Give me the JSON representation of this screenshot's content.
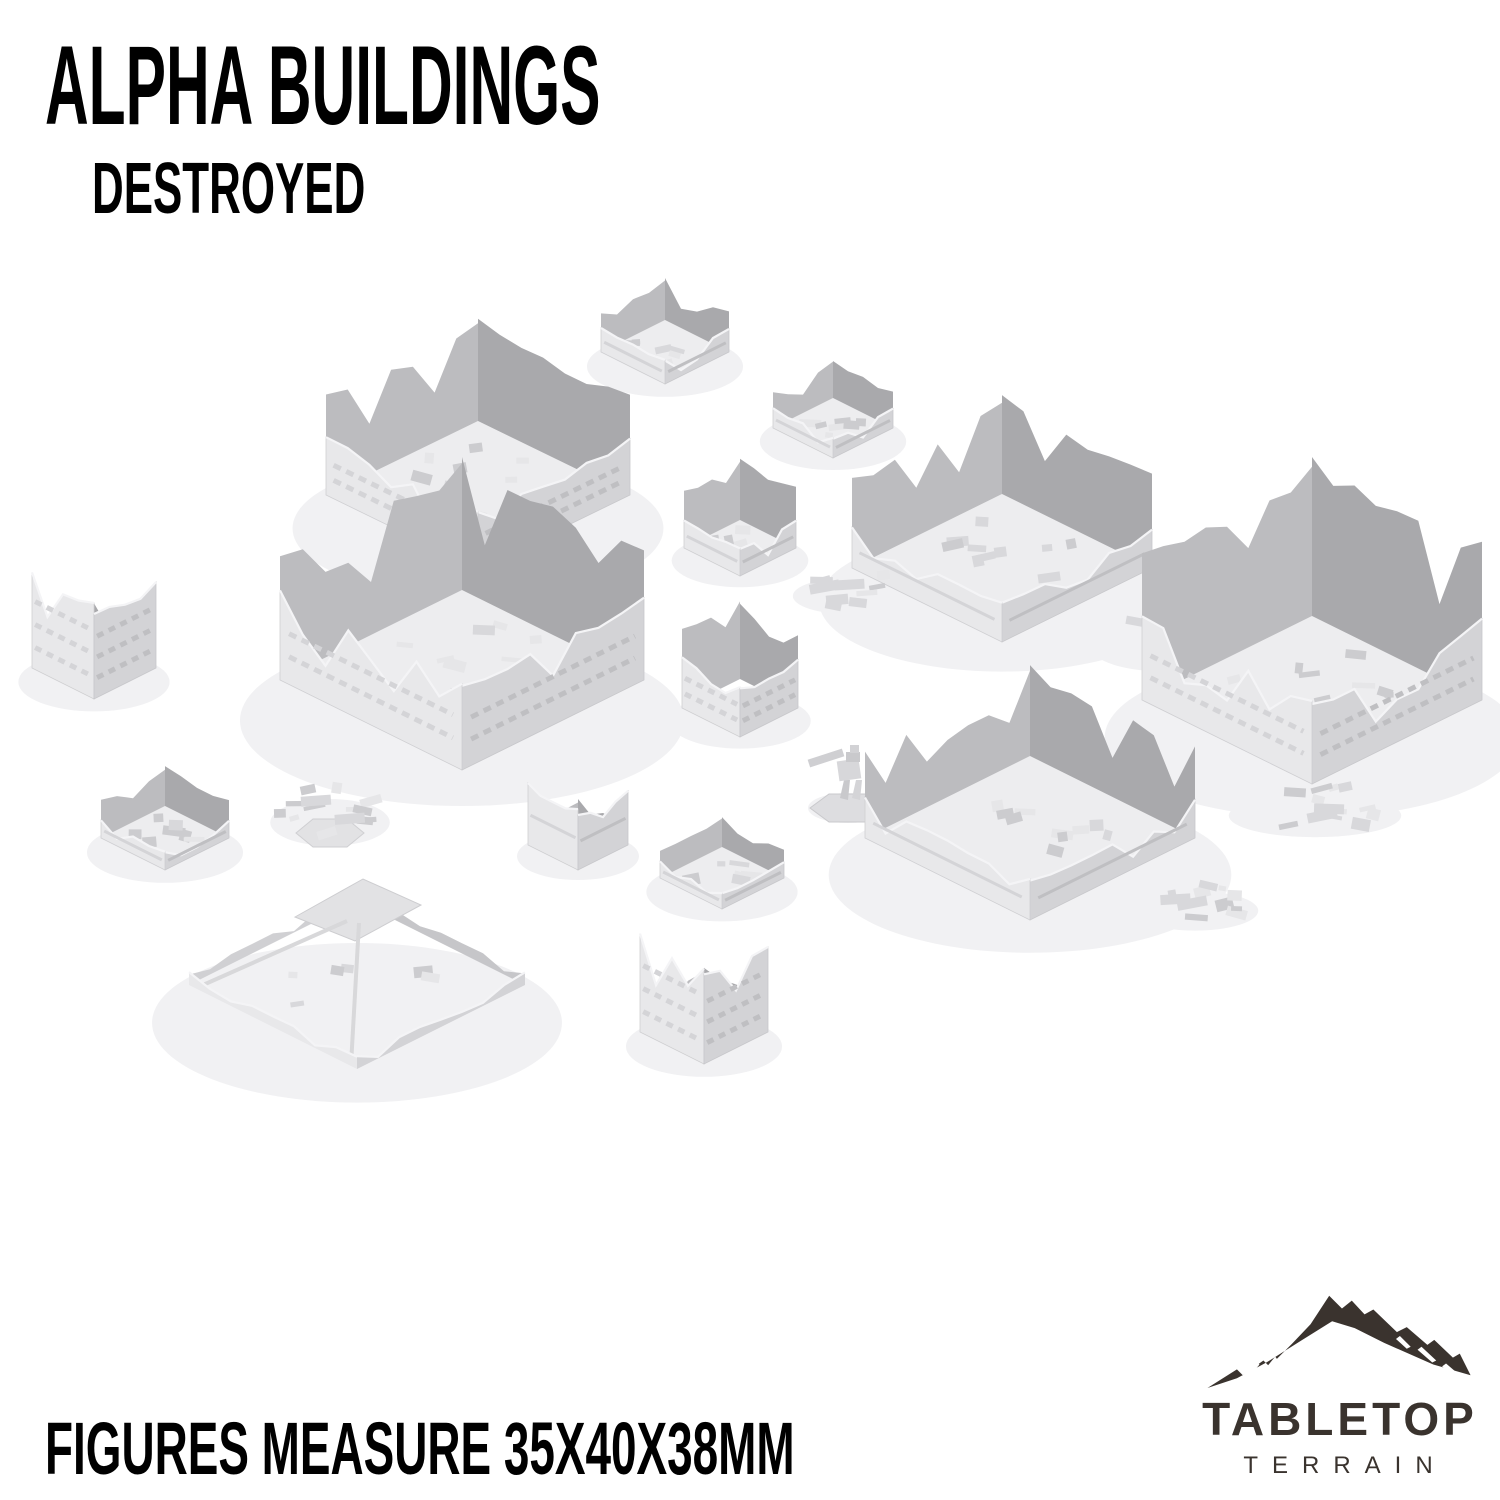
{
  "header": {
    "title": "ALPHA BUILDINGS",
    "subtitle": "DESTROYED"
  },
  "footer": {
    "note": "FIGURES MEASURE 35X40X38MM"
  },
  "logo": {
    "brand_top": "TABLETOP",
    "brand_bottom": "TERRAIN",
    "icon": "mountain-icon",
    "color": "#3a332e"
  },
  "palette": {
    "background": "#ffffff",
    "text": "#000000",
    "wall_lit": "#e8e8ea",
    "wall_shade": "#d3d3d6",
    "wall_top_highlight": "#f4f4f6",
    "interior_left": "#bcbcbf",
    "interior_right": "#a9a9ac",
    "floor": "#ededef",
    "band_lit": "#d4d4d7",
    "band_shade": "#bfbfc2",
    "rubble_light": "#e6e6e8",
    "rubble_mid": "#d8d8db",
    "rubble_dark": "#cccccf",
    "ground_shadow": "#f1f1f3",
    "logo_color": "#3a332e"
  },
  "scene": {
    "description": "Seventeen destroyed sci-fi building terrain models rendered in light grey on a white background",
    "models": [
      {
        "id": "ruin-small-top",
        "type": "enclosure",
        "cx": 665,
        "cy": 352,
        "hx": 64,
        "hy": 32,
        "hb": 42,
        "hf": 24,
        "seed": 11
      },
      {
        "id": "ruin-small-mid",
        "type": "enclosure",
        "cx": 833,
        "cy": 428,
        "hx": 60,
        "hy": 30,
        "hb": 38,
        "hf": 20,
        "seed": 22
      },
      {
        "id": "ruin-large-topleft",
        "type": "enclosure",
        "cx": 478,
        "cy": 495,
        "hx": 152,
        "hy": 74,
        "hb": 105,
        "hf": 58,
        "seed": 33,
        "windows": true
      },
      {
        "id": "ruin-wall-small-center",
        "type": "enclosure",
        "cx": 740,
        "cy": 548,
        "hx": 56,
        "hy": 28,
        "hb": 62,
        "hf": 28,
        "seed": 123
      },
      {
        "id": "ruin-large-center",
        "type": "enclosure",
        "cx": 1002,
        "cy": 568,
        "hx": 150,
        "hy": 74,
        "hb": 100,
        "hf": 40,
        "seed": 145
      },
      {
        "id": "rubble-center",
        "type": "rubble",
        "cx": 848,
        "cy": 588,
        "rx": 48,
        "ry": 20,
        "n": 10,
        "seed": 134
      },
      {
        "id": "rubble-center-right",
        "type": "rubble",
        "cx": 1168,
        "cy": 638,
        "rx": 66,
        "ry": 26,
        "n": 12,
        "seed": 156
      },
      {
        "id": "tower-left",
        "type": "corner",
        "cx": 94,
        "cy": 668,
        "hx": 62,
        "hy": 31,
        "hb": 100,
        "seed": 55,
        "windows": true
      },
      {
        "id": "building-large-left",
        "type": "enclosure",
        "cx": 462,
        "cy": 680,
        "hx": 182,
        "hy": 90,
        "hb": 135,
        "hf": 88,
        "seed": 44,
        "windows": true
      },
      {
        "id": "tower-open-center",
        "type": "tube",
        "cx": 740,
        "cy": 708,
        "hx": 58,
        "hy": 29,
        "hb": 80,
        "hf": 52,
        "seed": 101,
        "windows": true
      },
      {
        "id": "ruin-large-right",
        "type": "enclosure",
        "cx": 1312,
        "cy": 700,
        "hx": 170,
        "hy": 84,
        "hb": 160,
        "hf": 84,
        "seed": 189,
        "windows": true
      },
      {
        "id": "mech-figure",
        "type": "mech",
        "cx": 848,
        "cy": 782,
        "seed": 7
      },
      {
        "id": "rubble-hex-left",
        "type": "rubble",
        "cx": 330,
        "cy": 812,
        "rx": 52,
        "ry": 26,
        "n": 12,
        "hex": true,
        "seed": 77
      },
      {
        "id": "rubble-right-bottom",
        "type": "rubble",
        "cx": 1315,
        "cy": 806,
        "rx": 75,
        "ry": 24,
        "n": 11,
        "seed": 190
      },
      {
        "id": "ruin-large-bottomcenter",
        "type": "enclosure",
        "cx": 1030,
        "cy": 838,
        "hx": 165,
        "hy": 82,
        "hb": 92,
        "hf": 40,
        "seed": 167
      },
      {
        "id": "ruin-corner-left",
        "type": "enclosure",
        "cx": 165,
        "cy": 838,
        "hx": 64,
        "hy": 32,
        "hb": 40,
        "hf": 18,
        "seed": 66
      },
      {
        "id": "wall-corner-piece",
        "type": "corner",
        "cx": 578,
        "cy": 845,
        "hx": 50,
        "hy": 25,
        "hb": 62,
        "seed": 99
      },
      {
        "id": "ruin-low-square",
        "type": "enclosure",
        "cx": 722,
        "cy": 878,
        "hx": 62,
        "hy": 31,
        "hb": 30,
        "hf": 16,
        "seed": 112
      },
      {
        "id": "rubble-bottomcenter",
        "type": "rubble",
        "cx": 1195,
        "cy": 902,
        "rx": 55,
        "ry": 22,
        "n": 9,
        "seed": 178
      },
      {
        "id": "footprint-low",
        "type": "footprint",
        "cx": 357,
        "cy": 985,
        "hx": 168,
        "hy": 84,
        "seed": 88
      },
      {
        "id": "tower-bottom",
        "type": "corner",
        "cx": 704,
        "cy": 1032,
        "hx": 64,
        "hy": 32,
        "hb": 100,
        "seed": 201,
        "windows": true
      }
    ]
  }
}
